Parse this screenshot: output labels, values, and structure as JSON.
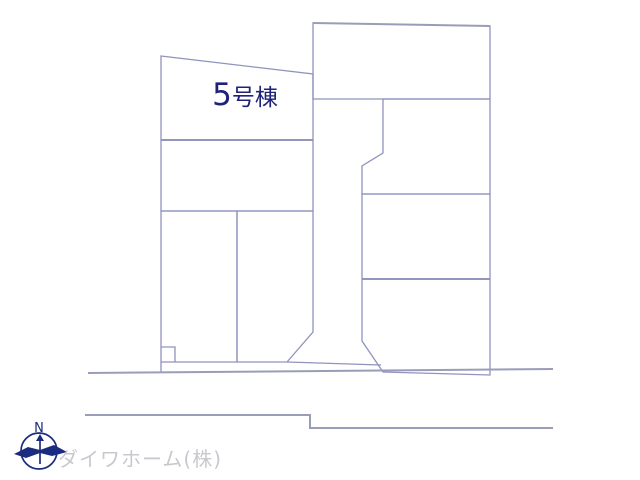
{
  "plan": {
    "title": "site-plan",
    "highlight_lot": {
      "number": "5",
      "suffix": "号棟"
    },
    "compass": {
      "label": "N"
    },
    "watermark": {
      "text": "ダイワホーム(株)"
    }
  },
  "colors": {
    "background": "#ffffff",
    "highlight_fill": "#f7d58f",
    "line_color": "#8f93be",
    "thick_line_color": "#9a9db8",
    "label_color": "#1f2277",
    "watermark_color": "#c8c8ce",
    "compass_color": "#1b2c80"
  }
}
